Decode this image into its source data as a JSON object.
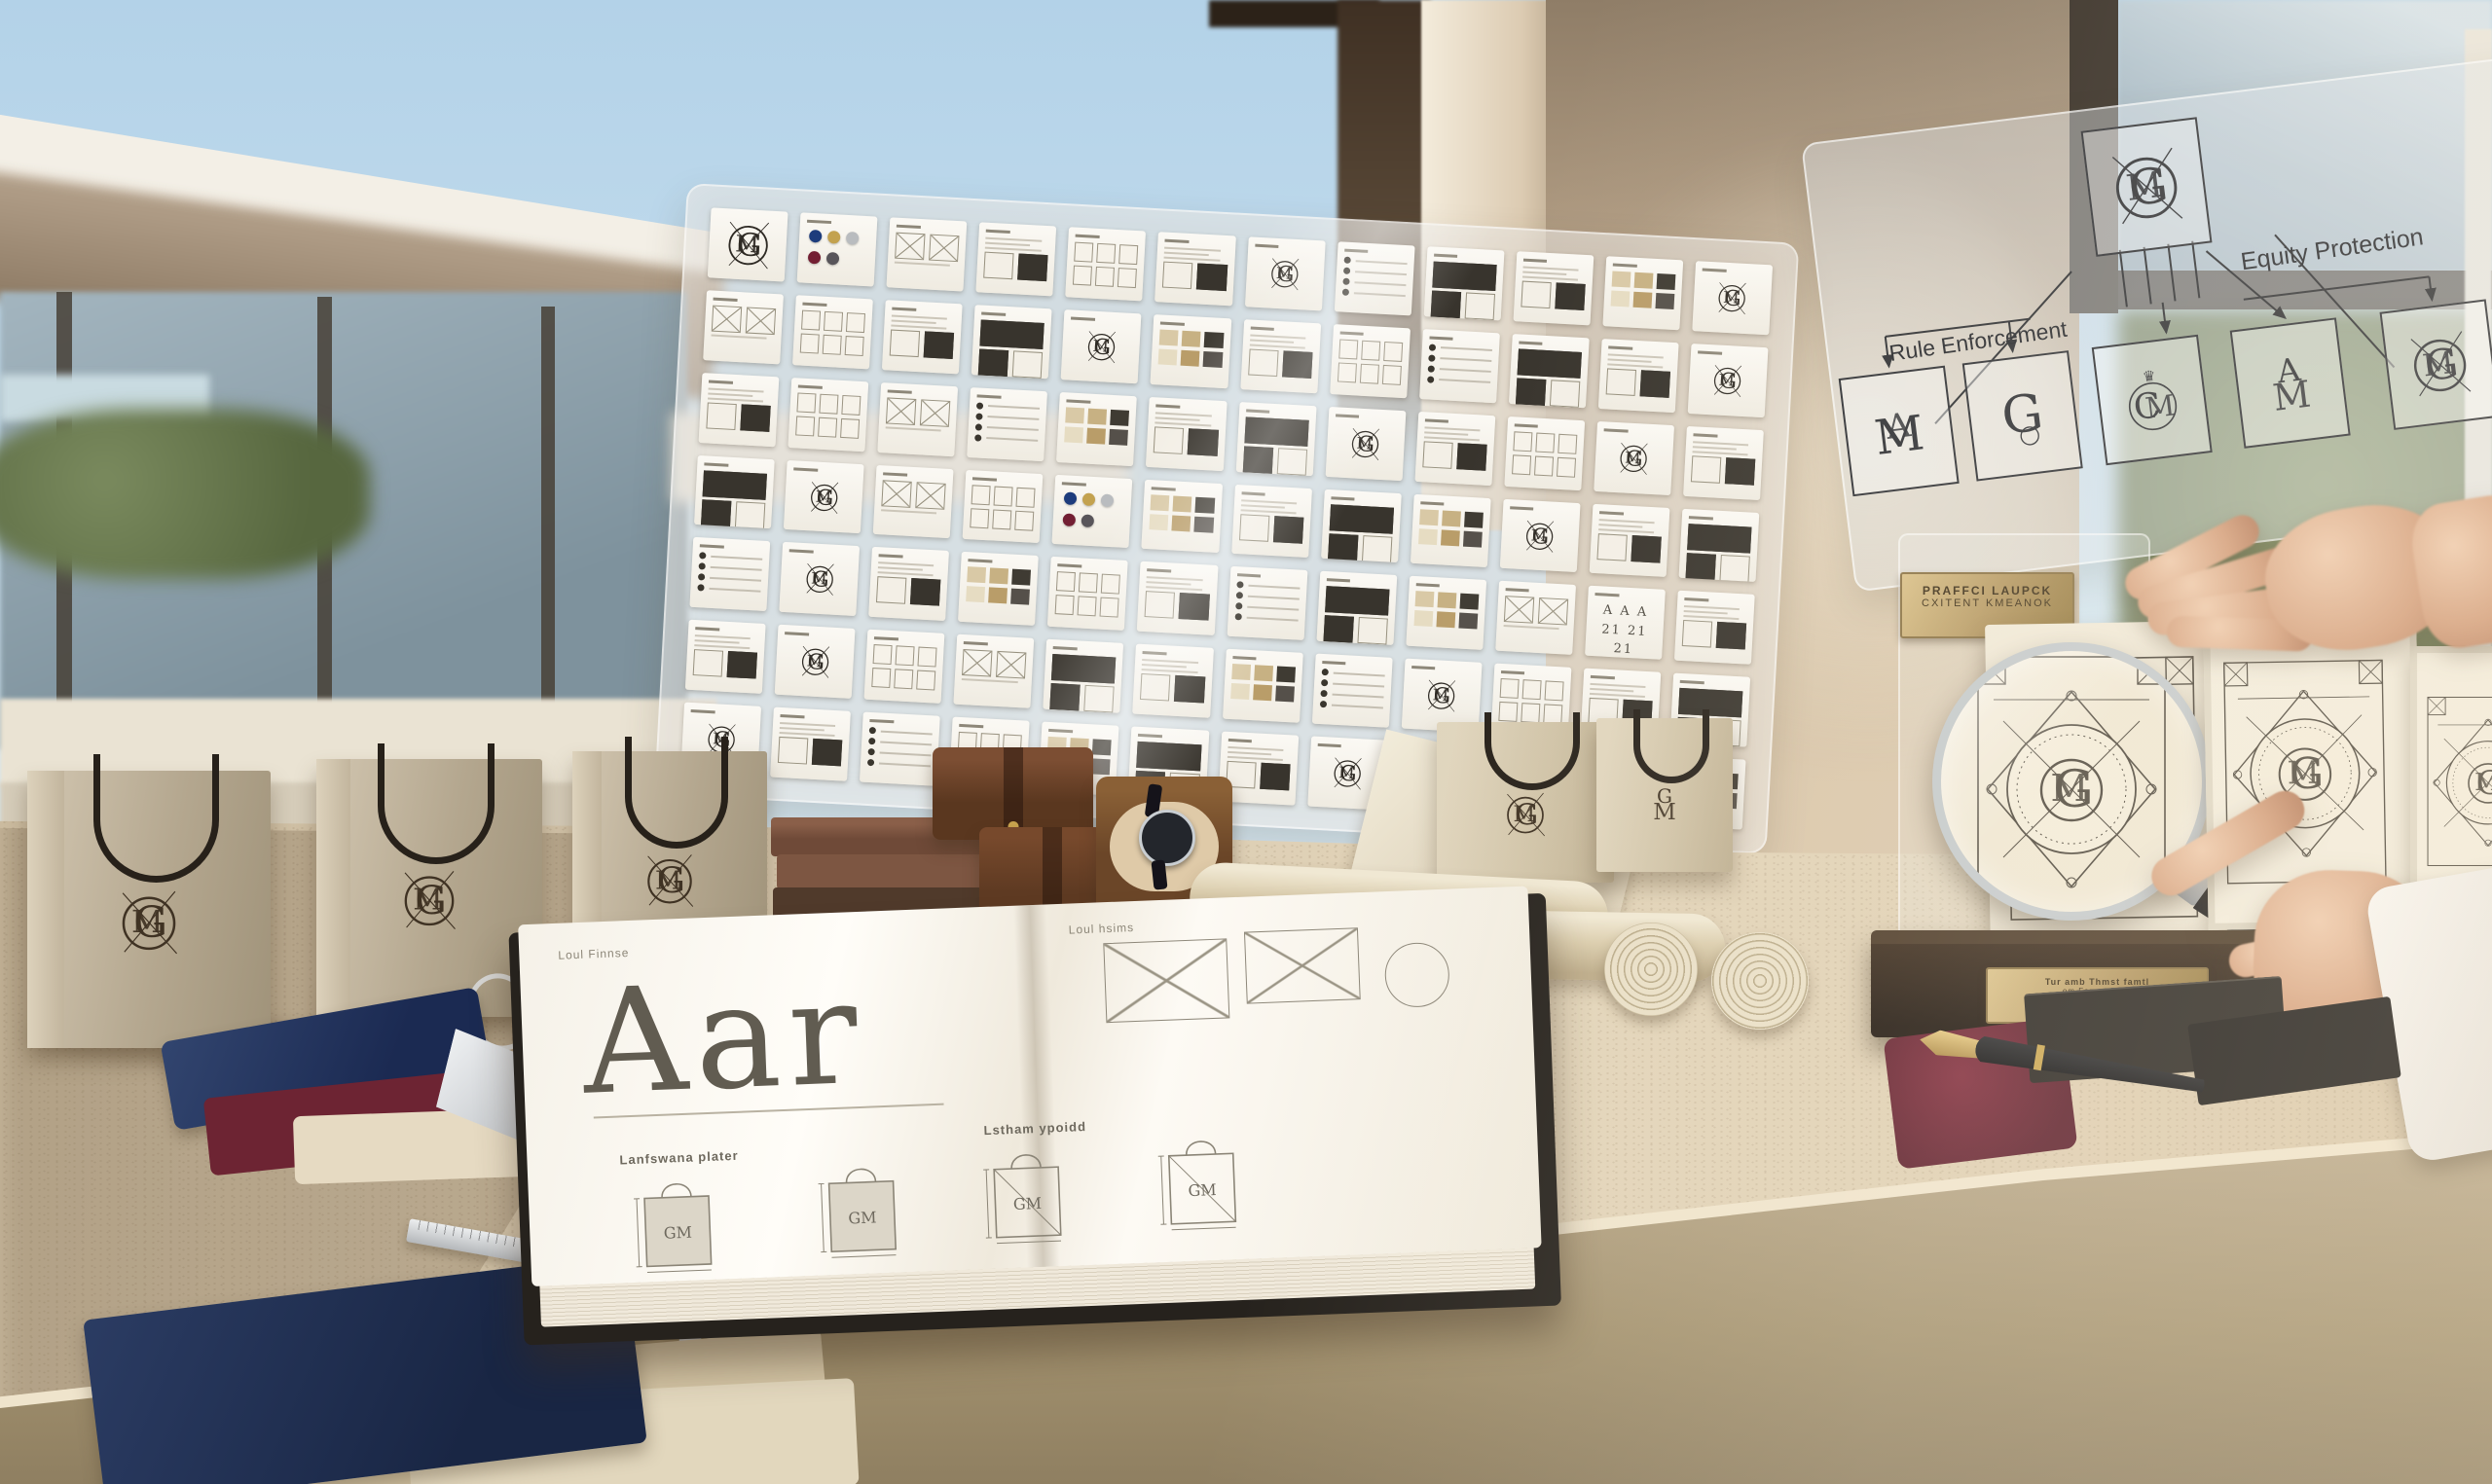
{
  "brand": {
    "monogram_primary": "G",
    "monogram_secondary": "M"
  },
  "diagram_panel": {
    "labels": {
      "rule_enforcement": "Rule Enforcement",
      "equity_protection": "Equity Protection"
    },
    "root_variant": "gm-circle",
    "variants": [
      {
        "id": "ma-interlock",
        "letters": "MA"
      },
      {
        "id": "g-serif",
        "letters": "G"
      },
      {
        "id": "cm-crowned",
        "letters": "CM",
        "crown": "♛"
      },
      {
        "id": "am-apex",
        "letters": "AM"
      },
      {
        "id": "gm-circle",
        "letters": "GM"
      }
    ]
  },
  "grid_panel": {
    "rows": 7,
    "cols": 12,
    "palette_dots": [
      "#1d3c7c",
      "#c3a24f",
      "#b9bcbf",
      "#731f33",
      "#58555a"
    ],
    "swatch_colors": [
      "#d9c9a6",
      "#c7b183",
      "#3f3b33",
      "#e6dcc2",
      "#b99d69",
      "#55504a"
    ],
    "type_specimen": "A A A",
    "type_specimen2": "21 21 21",
    "cards": [
      "logo",
      "palette",
      "layout",
      "spec",
      "grid",
      "spec",
      "mono",
      "list",
      "dark",
      "spec",
      "swatch",
      "mono",
      "layout",
      "grid",
      "spec",
      "dark",
      "mono",
      "swatch",
      "spec",
      "grid",
      "list",
      "dark",
      "spec",
      "mono",
      "spec",
      "grid",
      "layout",
      "list",
      "swatch",
      "spec",
      "dark",
      "mono",
      "spec",
      "grid",
      "mono",
      "spec",
      "dark",
      "mono",
      "layout",
      "grid",
      "palette",
      "swatch",
      "spec",
      "dark",
      "swatch",
      "mono",
      "spec",
      "dark",
      "list",
      "mono",
      "spec",
      "swatch",
      "grid",
      "spec",
      "list",
      "dark",
      "swatch",
      "layout",
      "type3",
      "spec",
      "spec",
      "mono",
      "grid",
      "layout",
      "dark",
      "spec",
      "swatch",
      "list",
      "mono",
      "grid",
      "spec",
      "dark",
      "mono",
      "spec",
      "list",
      "grid",
      "swatch",
      "dark",
      "spec",
      "mono",
      "layout",
      "spec",
      "grid",
      "swatch"
    ]
  },
  "book": {
    "header_left": "Loul Finnse",
    "header_right": "Loul hsims",
    "specimen": "Aar",
    "section_left": "Lanfswana plater",
    "section_right": "Lstham ypoidd"
  },
  "trophy": {
    "plaque_top_line1": "PRAFFCI LAUPCK",
    "plaque_top_line2": "CXITENT KMEANOK",
    "plaque_base_line1": "Tur amb Thmst famtl",
    "plaque_base_line2": "om Fammt Lang"
  }
}
